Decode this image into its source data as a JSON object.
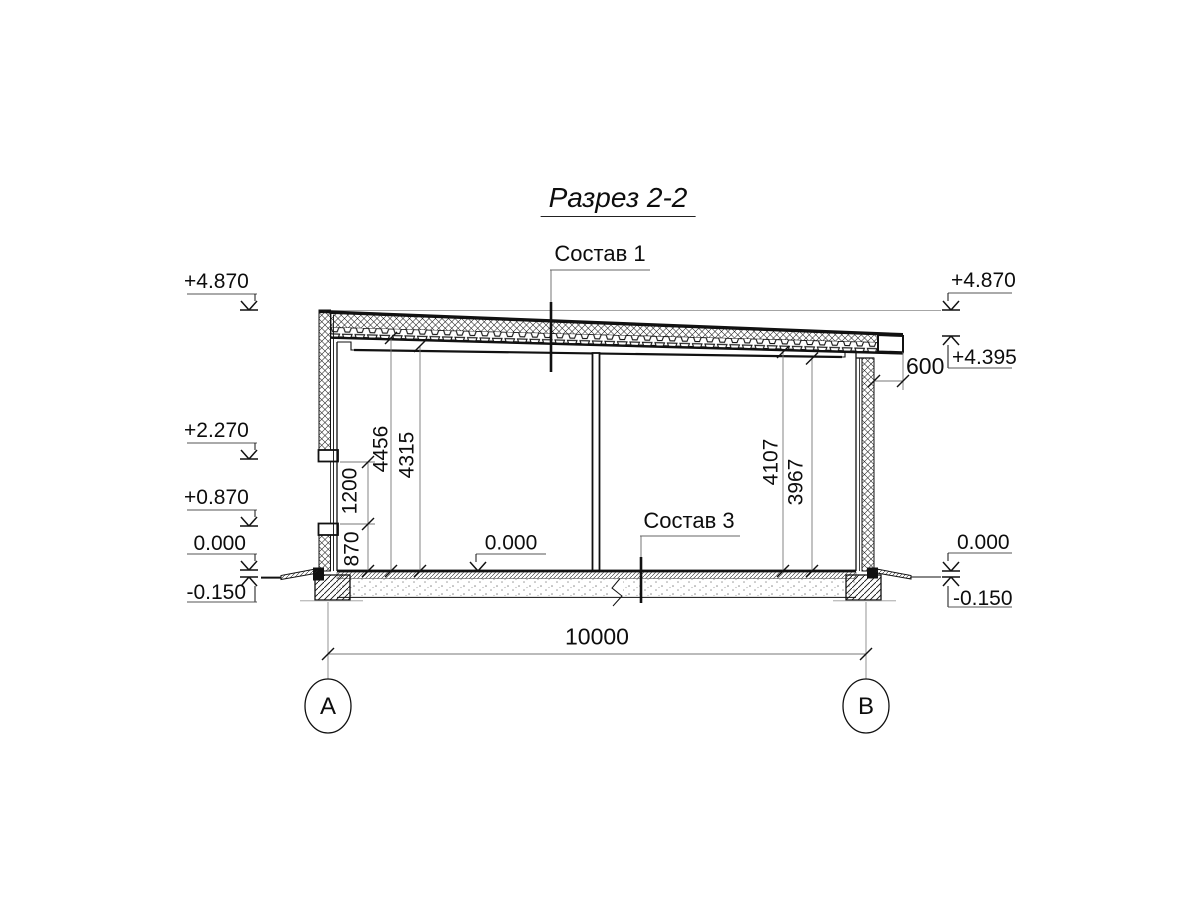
{
  "title": "Разрез 2-2",
  "callouts": {
    "roof": "Состав 1",
    "floor": "Состав 3"
  },
  "elev": {
    "l1": "+4.870",
    "l2": "+2.270",
    "l3": "+0.870",
    "l4": "0.000",
    "l5": "-0.150",
    "r1": "+4.870",
    "r2": "+4.395",
    "r3": "0.000",
    "r4": "-0.150",
    "mid": "0.000"
  },
  "dims": {
    "span": "10000",
    "overhang": "600",
    "d870": "870",
    "d1200": "1200",
    "d4456": "4456",
    "d4315": "4315",
    "d4107": "4107",
    "d3967": "3967"
  },
  "axes": {
    "a": "А",
    "b": "В"
  },
  "colors": {
    "line": "#111111",
    "dim": "#777777",
    "level": "#999999"
  }
}
